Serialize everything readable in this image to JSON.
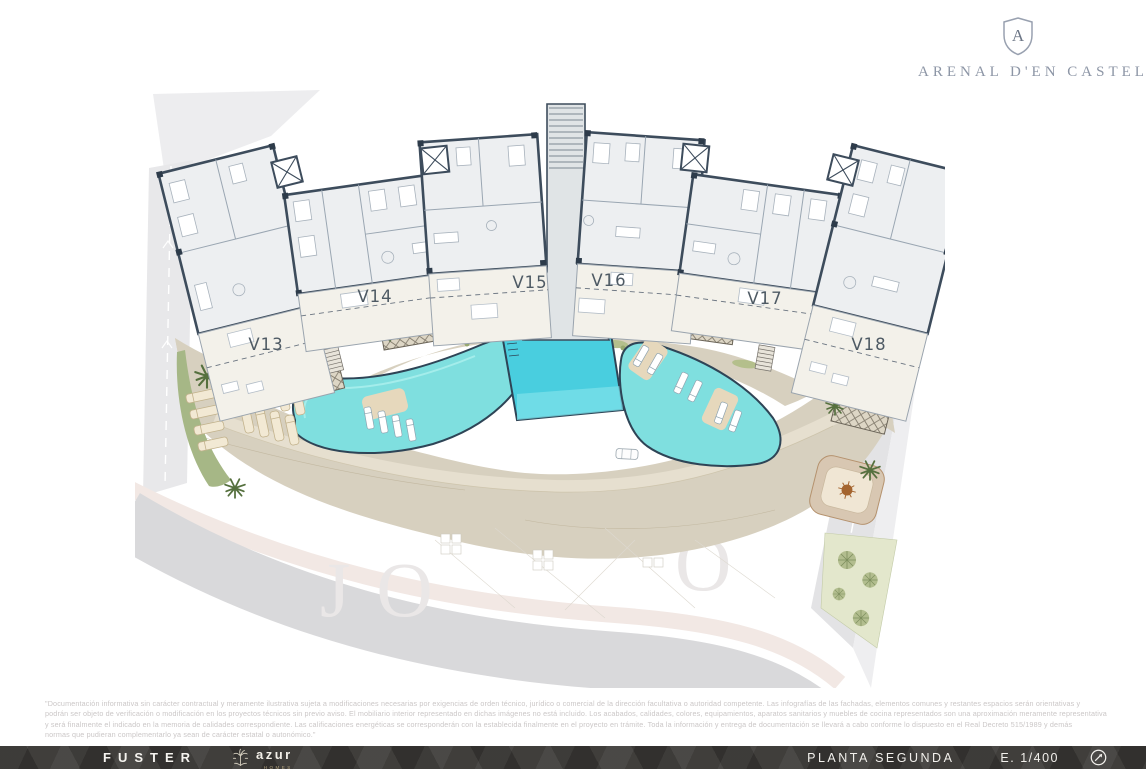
{
  "brand": {
    "monogram": "A",
    "name": "ARENAL D'EN CASTELL"
  },
  "plan": {
    "units": [
      {
        "label": "V13"
      },
      {
        "label": "V14"
      },
      {
        "label": "V15"
      },
      {
        "label": "V16"
      },
      {
        "label": "V17"
      },
      {
        "label": "V18"
      }
    ],
    "watermark": {
      "left": "JO",
      "right": "O"
    }
  },
  "disclaimer": {
    "lines": [
      "\"Documentación informativa sin carácter contractual y meramente ilustrativa sujeta a modificaciones necesarias por exigencias de orden técnico, jurídico o comercial de la dirección facultativa o autoridad competente. Las infografías de las fachadas, elementos comunes y restantes espacios serán orientativas y",
      "podrán ser objeto de verificación o modificación en los proyectos técnicos sin previo aviso. El mobiliario interior representado en dichas imágenes no está incluido. Los acabados, calidades, colores, equipamientos, aparatos sanitarios y muebles de cocina representados son una aproximación meramente representativa",
      "y será finalmente el indicado en la memoria de calidades correspondiente. Las calificaciones energéticas se corresponderán con la establecida finalmente en el proyecto en trámite. Toda la información y entrega de documentación se llevará a cabo conforme lo dispuesto en el Real Decreto 515/1989 y demás",
      "normas que pudieran complementarlo ya sean de carácter estatal o autonómico.\""
    ]
  },
  "footer": {
    "developer": "FUSTER",
    "agency": "azur",
    "agency_sub": "HOMES",
    "floor_label": "PLANTA SEGUNDA",
    "scale_label": "E. 1/400"
  },
  "colors": {
    "wall": "#3d4c5c",
    "pool": "#7fdfdf",
    "pool_deep": "#49cedf",
    "deck": "#d7d0bf",
    "road": "#e4e4e6",
    "green": "#a9b988",
    "footer_bg": "#403e3b",
    "brand_text": "#8d96a6"
  }
}
